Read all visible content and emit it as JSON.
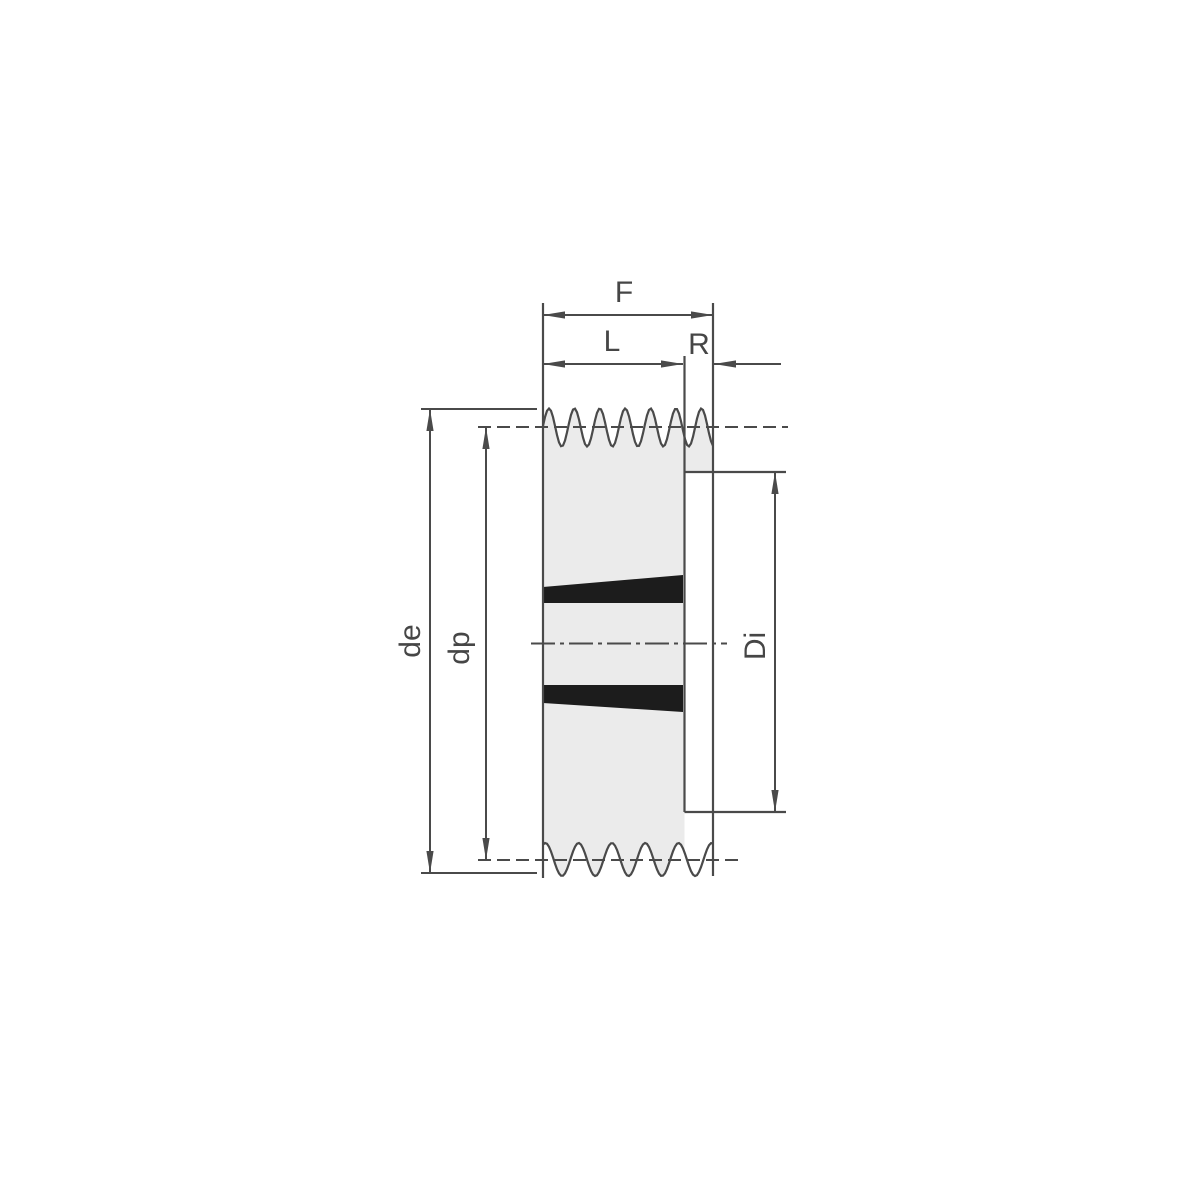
{
  "drawing": {
    "kind": "v-belt pulley cross-section with taper bushing",
    "labels": {
      "total_width": "F",
      "rim_width": "L",
      "bush_offset": "R",
      "outside_diameter": "de",
      "pitch_diameter": "dp",
      "recess_diameter": "Di"
    },
    "colors": {
      "line": "#4a4a4a",
      "body_fill": "#ebebeb",
      "bush_fill": "#1c1c1c",
      "background": "#ffffff",
      "label_text": "#464646"
    }
  }
}
